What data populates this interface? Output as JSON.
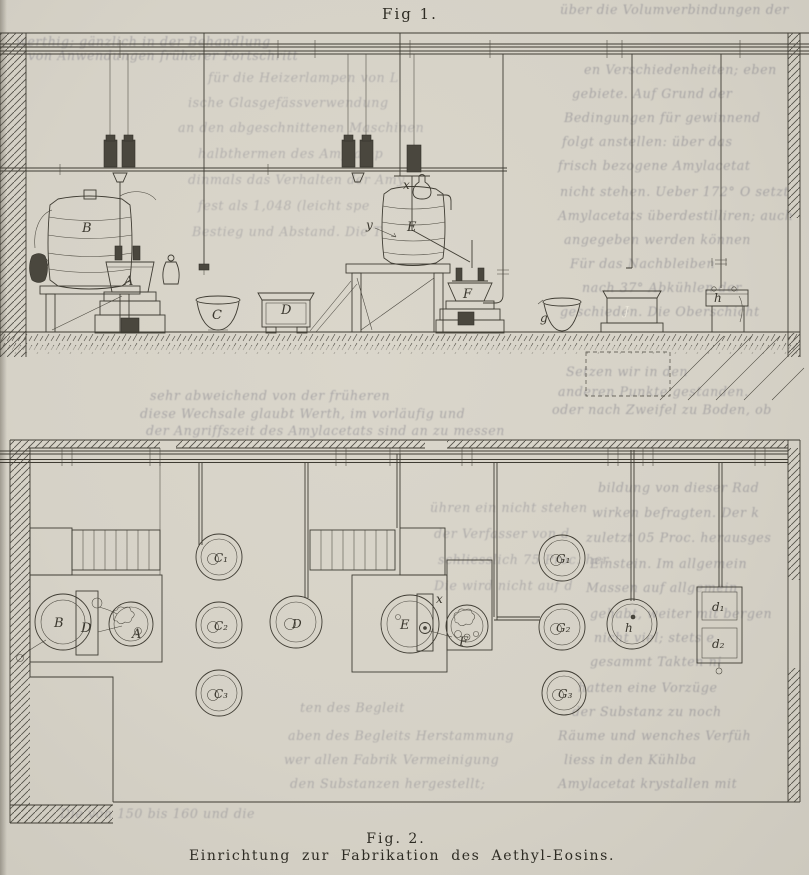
{
  "page": {
    "paper_color": "#d7d3c9",
    "ink_color": "#3f3c33"
  },
  "fig1": {
    "title": "Fig 1.",
    "labels": {
      "barrel_left": "B",
      "kettle_left": "A",
      "bowl_left": "C",
      "tub_left": "D",
      "barrel_right": "E",
      "cap": "x",
      "drive": "y",
      "kettle_right": "F",
      "bowl_right": "g",
      "tub_right": "J",
      "vessel_right": "h"
    }
  },
  "fig2": {
    "title": "Fig. 2.",
    "caption": "Einrichtung zur Fabrikation des Aethyl-Eosins.",
    "labels": {
      "circle_b": "B",
      "rect_d": "D",
      "circle_a": "A",
      "vat_c1": "C₁",
      "vat_c2": "C₂",
      "vat_c3": "C₃",
      "circle_d": "D",
      "circle_e": "E",
      "rect_x": "x",
      "circle_f": "F",
      "vat_g1": "G₁",
      "vat_g2": "G₂",
      "vat_g3": "G₃",
      "circle_h": "h",
      "box_d1": "d₁",
      "box_d2": "d₂"
    }
  },
  "ghost": [
    "werthig; gänzlich in der Behandlung",
    "von Anwendungen früherer Fortschritt",
    "über die Volumverbindungen der",
    "en Verschiedenheiten; eben",
    "gebiete. Auf Grund der",
    "Bedingungen für gewinnend",
    "folgt anstellen: über das",
    "frisch bezogene Amylacetat",
    "nicht stehen. Ueber 172° O setzt",
    "Amylacetats überdestilliren; auch",
    "angegeben werden können",
    "Für das Nachbleiben",
    "nach 37° Abkühlen der",
    "geschieden. Die Oberschicht",
    "Setzen wir in den",
    "anderen Punkte gestanden.",
    "oder nach Zweifel zu Boden, ob",
    "für die Heizerlampen von L",
    "ische Glasgefässverwendung",
    "an den abgeschnittenen Maschinen",
    "halbthermen des Amylamp",
    "dinmals das Verhalten der Amy",
    "fest als 1,048 (leicht spe",
    "Bestieg und Abstand. Die T",
    "sehr abweichend von der früheren",
    "diese Wechsale glaubt Werth, im vorläufig und",
    "der Angriffszeit des Amylacetats sind an zu messen",
    "bildung von dieser Rad",
    "wirken befragten. Der k",
    "zuletzt 05 Proc. herausges",
    "Einstein. Im allgemein",
    "Massen auf allgemein",
    "gehabt, weiter mit bergen",
    "nicht viel; stets e",
    "gesammt Takten ni",
    "hatten eine Vorzüge",
    "der Substanz zu noch",
    "Räume und wenches Verfüh",
    "liess in den Kühlba",
    "Amylacetat krystallen mit",
    "ten des Begleit",
    "aben des Begleits    Herstammung",
    "wer allen Fabrik    Vermeinigung",
    "den Substanzen    hergestellt;",
    "Die von 150 bis 160 und die",
    "ühren ein nicht stehen",
    "der Verfasser von d",
    "schliesslich 75 Proc. her",
    "Die wird nicht auf d"
  ]
}
